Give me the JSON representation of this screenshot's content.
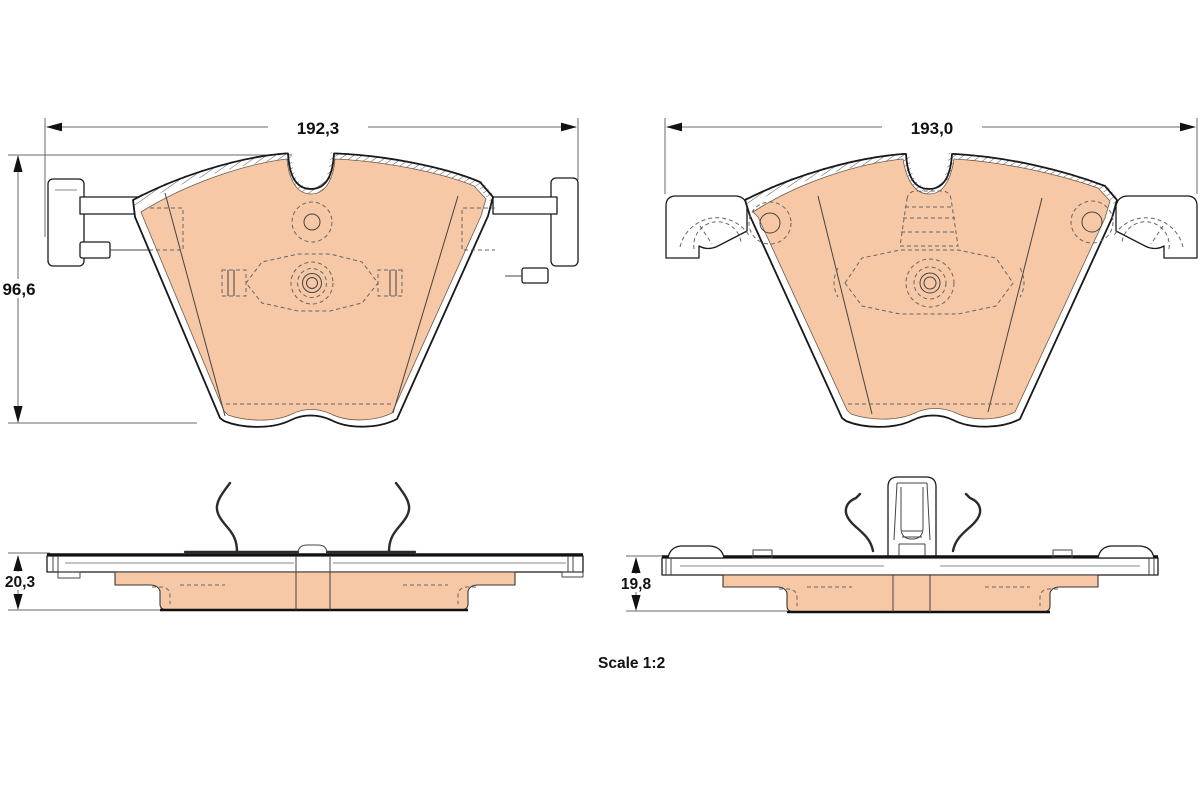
{
  "drawing": {
    "type": "brake-pad technical drawing, two pads with front and side views",
    "scale_label": "Scale 1:2",
    "left_pad": {
      "width_mm": "192,3",
      "height_mm": "96,6",
      "thickness_mm": "20,3"
    },
    "right_pad": {
      "width_mm": "193,0",
      "thickness_mm": "19,8"
    },
    "colors": {
      "friction_material": "#f6c8a6",
      "outline": "#1a1a1a",
      "dimension_lines": "#6a6a6a",
      "hidden_lines": "#555555",
      "background": "#ffffff"
    }
  }
}
